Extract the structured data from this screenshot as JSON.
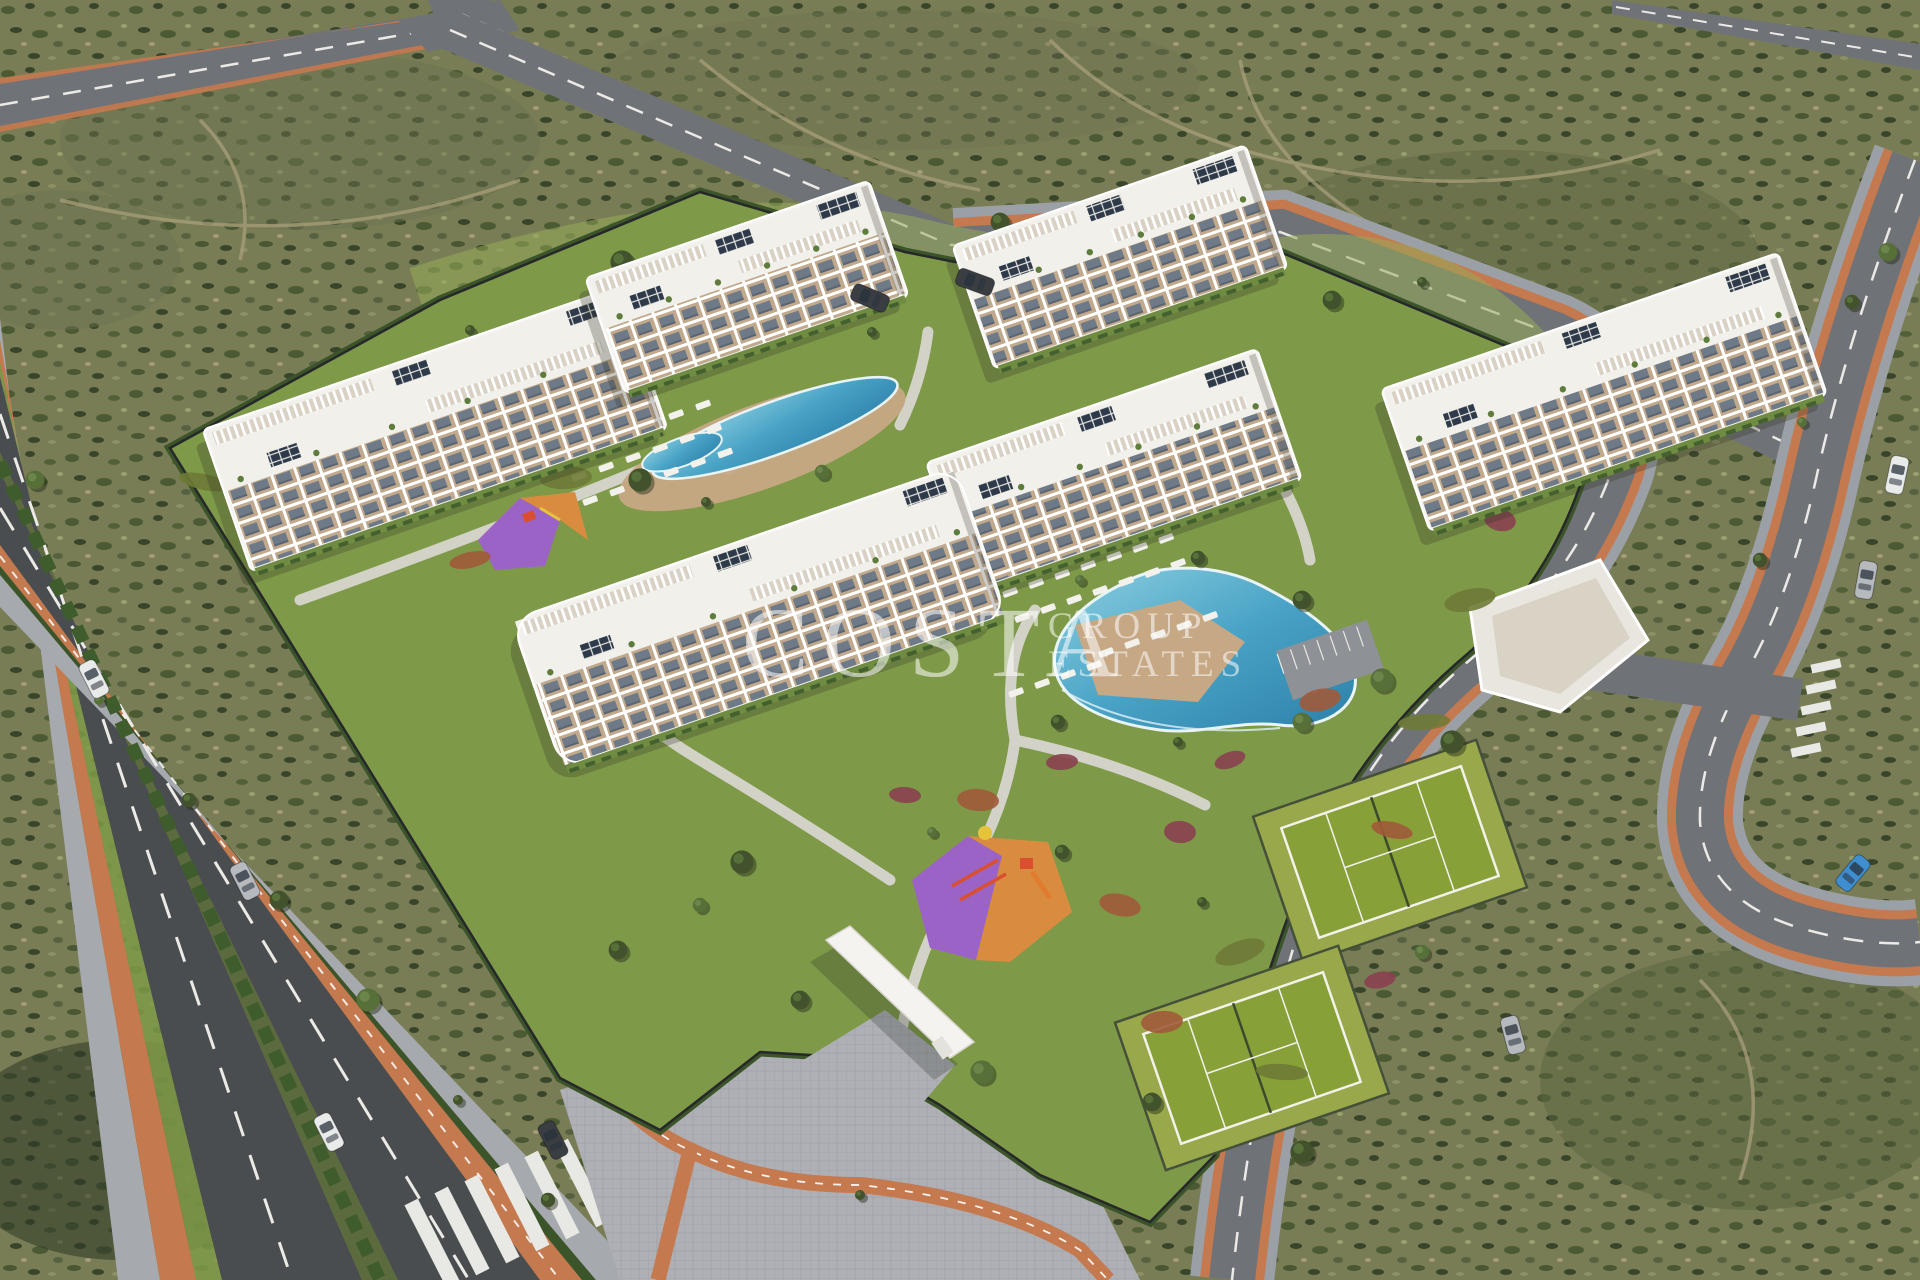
{
  "watermark": {
    "primary": "COSTA",
    "secondary": "GROUP",
    "tertiary": "ESTATES"
  },
  "scene": {
    "type": "aerial-3d-render-residential-complex",
    "buildings": 6,
    "pools": 2,
    "tennis_courts": 2,
    "playgrounds": 2,
    "cars": 10
  },
  "colors": {
    "terrain": "#797d56",
    "terrain_dark": "#55603a",
    "terrain_darker": "#39452b",
    "terrain_light": "#8d9066",
    "trail": "#a89f7a",
    "shade": "#2e3826",
    "road": "#6f7277",
    "road_dark": "#4a4d4f",
    "road_light": "#9ba0a6",
    "sidewalk": "#a6aaaf",
    "paver": "#aeb0b6",
    "lane_white": "#eceae6",
    "bike_orange": "#c5794f",
    "lawn": "#7e9a48",
    "lawn_light": "#95ab57",
    "hedge": "#3c5429",
    "fence": "#26282a",
    "path": "#d8d5cf",
    "bed_red": "#8a4050",
    "bed_rust": "#a05a3a",
    "bld": "#f4f3ef",
    "roof": "#f1f0ea",
    "balcony_tan": "#c0a98c",
    "glass": "#6f7a88",
    "solar": "#2e3a49",
    "pergola_base": "#d8d1c4",
    "pool_light": "#8ed0e0",
    "pool_mid": "#49a3c6",
    "pool_deep": "#2c7fa8",
    "deck": "#c7a885",
    "court": "#87a038",
    "court_apron": "#98a84a",
    "play_purple": "#9c63c6",
    "play_orange": "#d98c3f",
    "eq_red": "#d94f2f",
    "eq_yellow": "#e5c43c",
    "car_white": "#e9eaea",
    "car_silver": "#b6b9bd",
    "car_dark": "#3a3e42",
    "car_blue": "#3e8ed0"
  }
}
